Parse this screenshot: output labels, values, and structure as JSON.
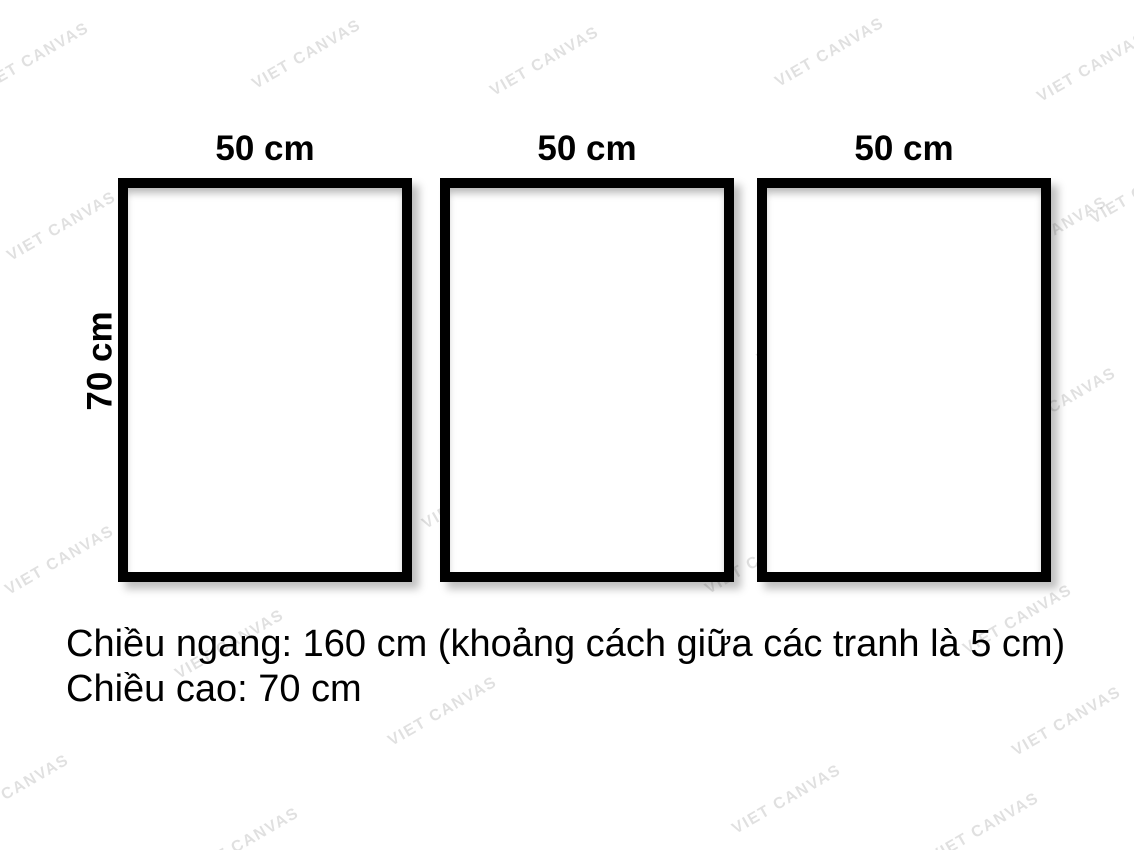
{
  "page": {
    "background": "#ffffff",
    "frame_border_color": "#000000",
    "canvas_fill_color": "#ffffff",
    "text_color": "#000000"
  },
  "frames": [
    {
      "name": "left",
      "width_label": "50 cm"
    },
    {
      "name": "center",
      "width_label": "50 cm"
    },
    {
      "name": "right",
      "width_label": "50 cm"
    }
  ],
  "height_label": "70 cm",
  "caption": {
    "line1": "Chiều ngang: 160 cm (khoảng cách giữa các tranh là 5 cm)",
    "line2": "Chiều cao: 70 cm"
  },
  "watermark": {
    "text": "VIET CANVAS",
    "color": "rgba(0,0,0,0.12)",
    "positions": [
      [
        35,
        58
      ],
      [
        307,
        55
      ],
      [
        545,
        62
      ],
      [
        830,
        53
      ],
      [
        1092,
        68
      ],
      [
        62,
        227
      ],
      [
        267,
        222
      ],
      [
        555,
        240
      ],
      [
        812,
        330
      ],
      [
        1053,
        232
      ],
      [
        338,
        406
      ],
      [
        1062,
        403
      ],
      [
        60,
        561
      ],
      [
        477,
        495
      ],
      [
        760,
        560
      ],
      [
        230,
        645
      ],
      [
        443,
        712
      ],
      [
        1018,
        620
      ],
      [
        15,
        790
      ],
      [
        787,
        800
      ],
      [
        985,
        828
      ],
      [
        1067,
        722
      ],
      [
        245,
        843
      ],
      [
        570,
        470
      ],
      [
        1145,
        190
      ]
    ]
  }
}
